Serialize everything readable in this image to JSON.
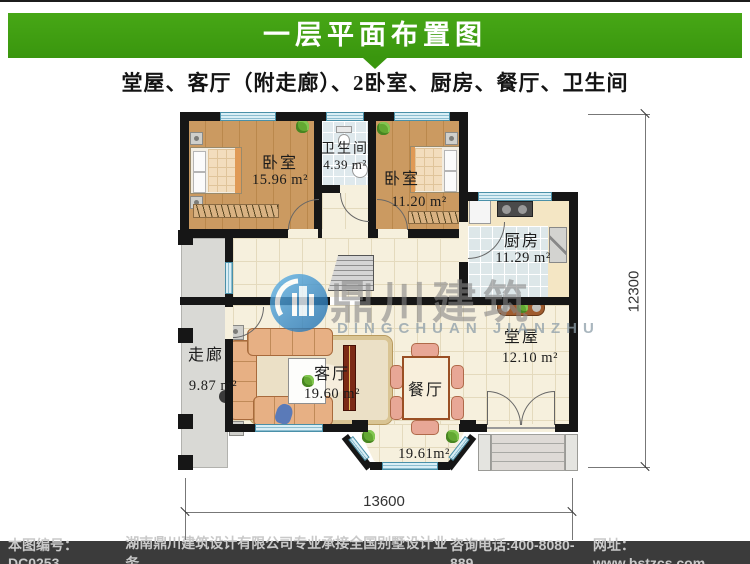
{
  "header": {
    "title": "一层平面布置图"
  },
  "subtitle": "堂屋、客厅（附走廊）、2卧室、厨房、餐厅、卫生间",
  "watermark": {
    "cn": "鼎川建筑",
    "en": "DINGCHUAN JIANZHU"
  },
  "rooms": {
    "bedroom_left": {
      "name": "卧室",
      "area": "15.96 m²"
    },
    "bathroom": {
      "name": "卫生间",
      "area": "4.39 m²"
    },
    "bedroom_right": {
      "name": "卧室",
      "area": "11.20 m²"
    },
    "kitchen": {
      "name": "厨房",
      "area": "11.29 m²"
    },
    "corridor": {
      "name": "走廊",
      "area": "9.87 m²"
    },
    "living": {
      "name": "客厅",
      "area": "19.60 m²"
    },
    "dining": {
      "name": "餐厅",
      "area": "19.61m²"
    },
    "hall": {
      "name": "堂屋",
      "area": "12.10 m²"
    }
  },
  "dimensions": {
    "width_mm": "13600",
    "height_mm": "12300"
  },
  "footer": {
    "drawing_no": "本图编号：DC0253",
    "company": "湖南鼎川建筑设计有限公司专业承接全国别墅设计业务",
    "phone": "咨询电话:400-8080-889",
    "website": "网址：www.bstzcs.com"
  },
  "colors": {
    "header_green": "#3f9e12",
    "footer_bg": "#3b3b3b",
    "footer_text": "#c9c9c9",
    "wall_black": "#161616",
    "window_blue": "#d9eef5",
    "wood_floor": "#cb9a61",
    "tile_cream": "#f6f0dd",
    "tile_blue": "#dfe9ed",
    "corridor_gray": "#d9d9d5",
    "watermark_blue": "#2f86c8"
  }
}
